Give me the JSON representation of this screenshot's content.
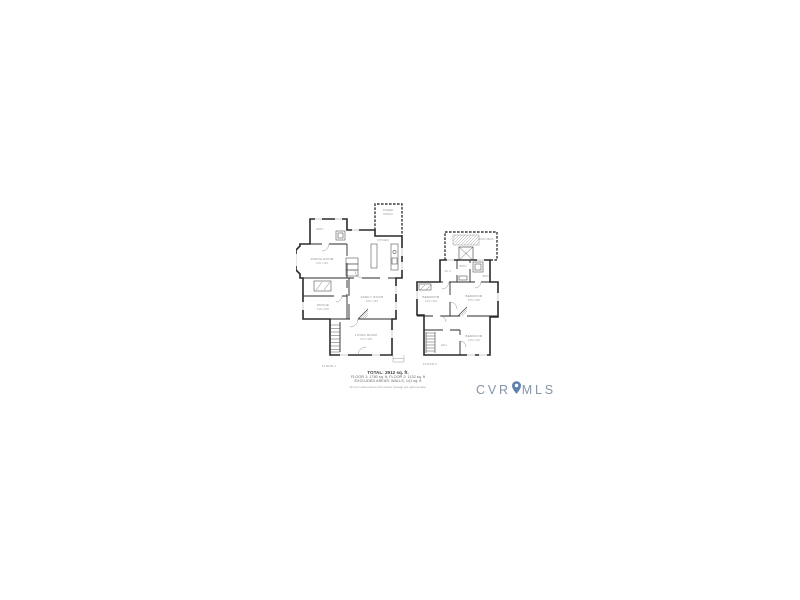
{
  "page": {
    "background": "#ffffff"
  },
  "footer": {
    "total_line": "TOTAL: 2912 sq. ft.",
    "floors_line": "FLOOR 1: 1780 sq. ft, FLOOR 2: 1132 sq. ft",
    "excluded_line": "EXCLUDED AREAS: WALLS, 141 sq. ft",
    "disclaimer_line": "All room dimensions and square footage are approximate."
  },
  "logo": {
    "prefix": "CVR",
    "suffix": "MLS",
    "icon": "map-pin-icon",
    "text_color": "#8695A8",
    "pin_color": "#5E82AC"
  },
  "floor1": {
    "caption": "FLOOR 1",
    "rooms": {
      "porch_l1": "SCREEN",
      "porch_l2": "PORCH",
      "bath": "BATH",
      "dining_name": "DINING ROOM",
      "dining_dims": "12'6 x 11'6",
      "kitchen": "KITCHEN",
      "family_name": "FAMILY ROOM",
      "family_dims": "16'0 x 14'0",
      "office_name": "OFFICE",
      "office_dims": "11'6 x 10'6",
      "living_name": "LIVING ROOM",
      "living_dims": "17'0 x 13'0"
    }
  },
  "floor2": {
    "caption": "FLOOR 2",
    "rooms": {
      "roof_deck": "ROOF DECK",
      "wic": "W.I.C.",
      "bath_a": "BATH",
      "bath_b": "BATH",
      "bed_left_name": "BEDROOM",
      "bed_left_dims": "12'0 x 11'0",
      "bed_main_name": "BEDROOM",
      "bed_main_dims": "15'6 x 13'0",
      "bed_rear_name": "BEDROOM",
      "bed_rear_dims": "12'6 x 11'0",
      "hall": "HALL"
    }
  }
}
